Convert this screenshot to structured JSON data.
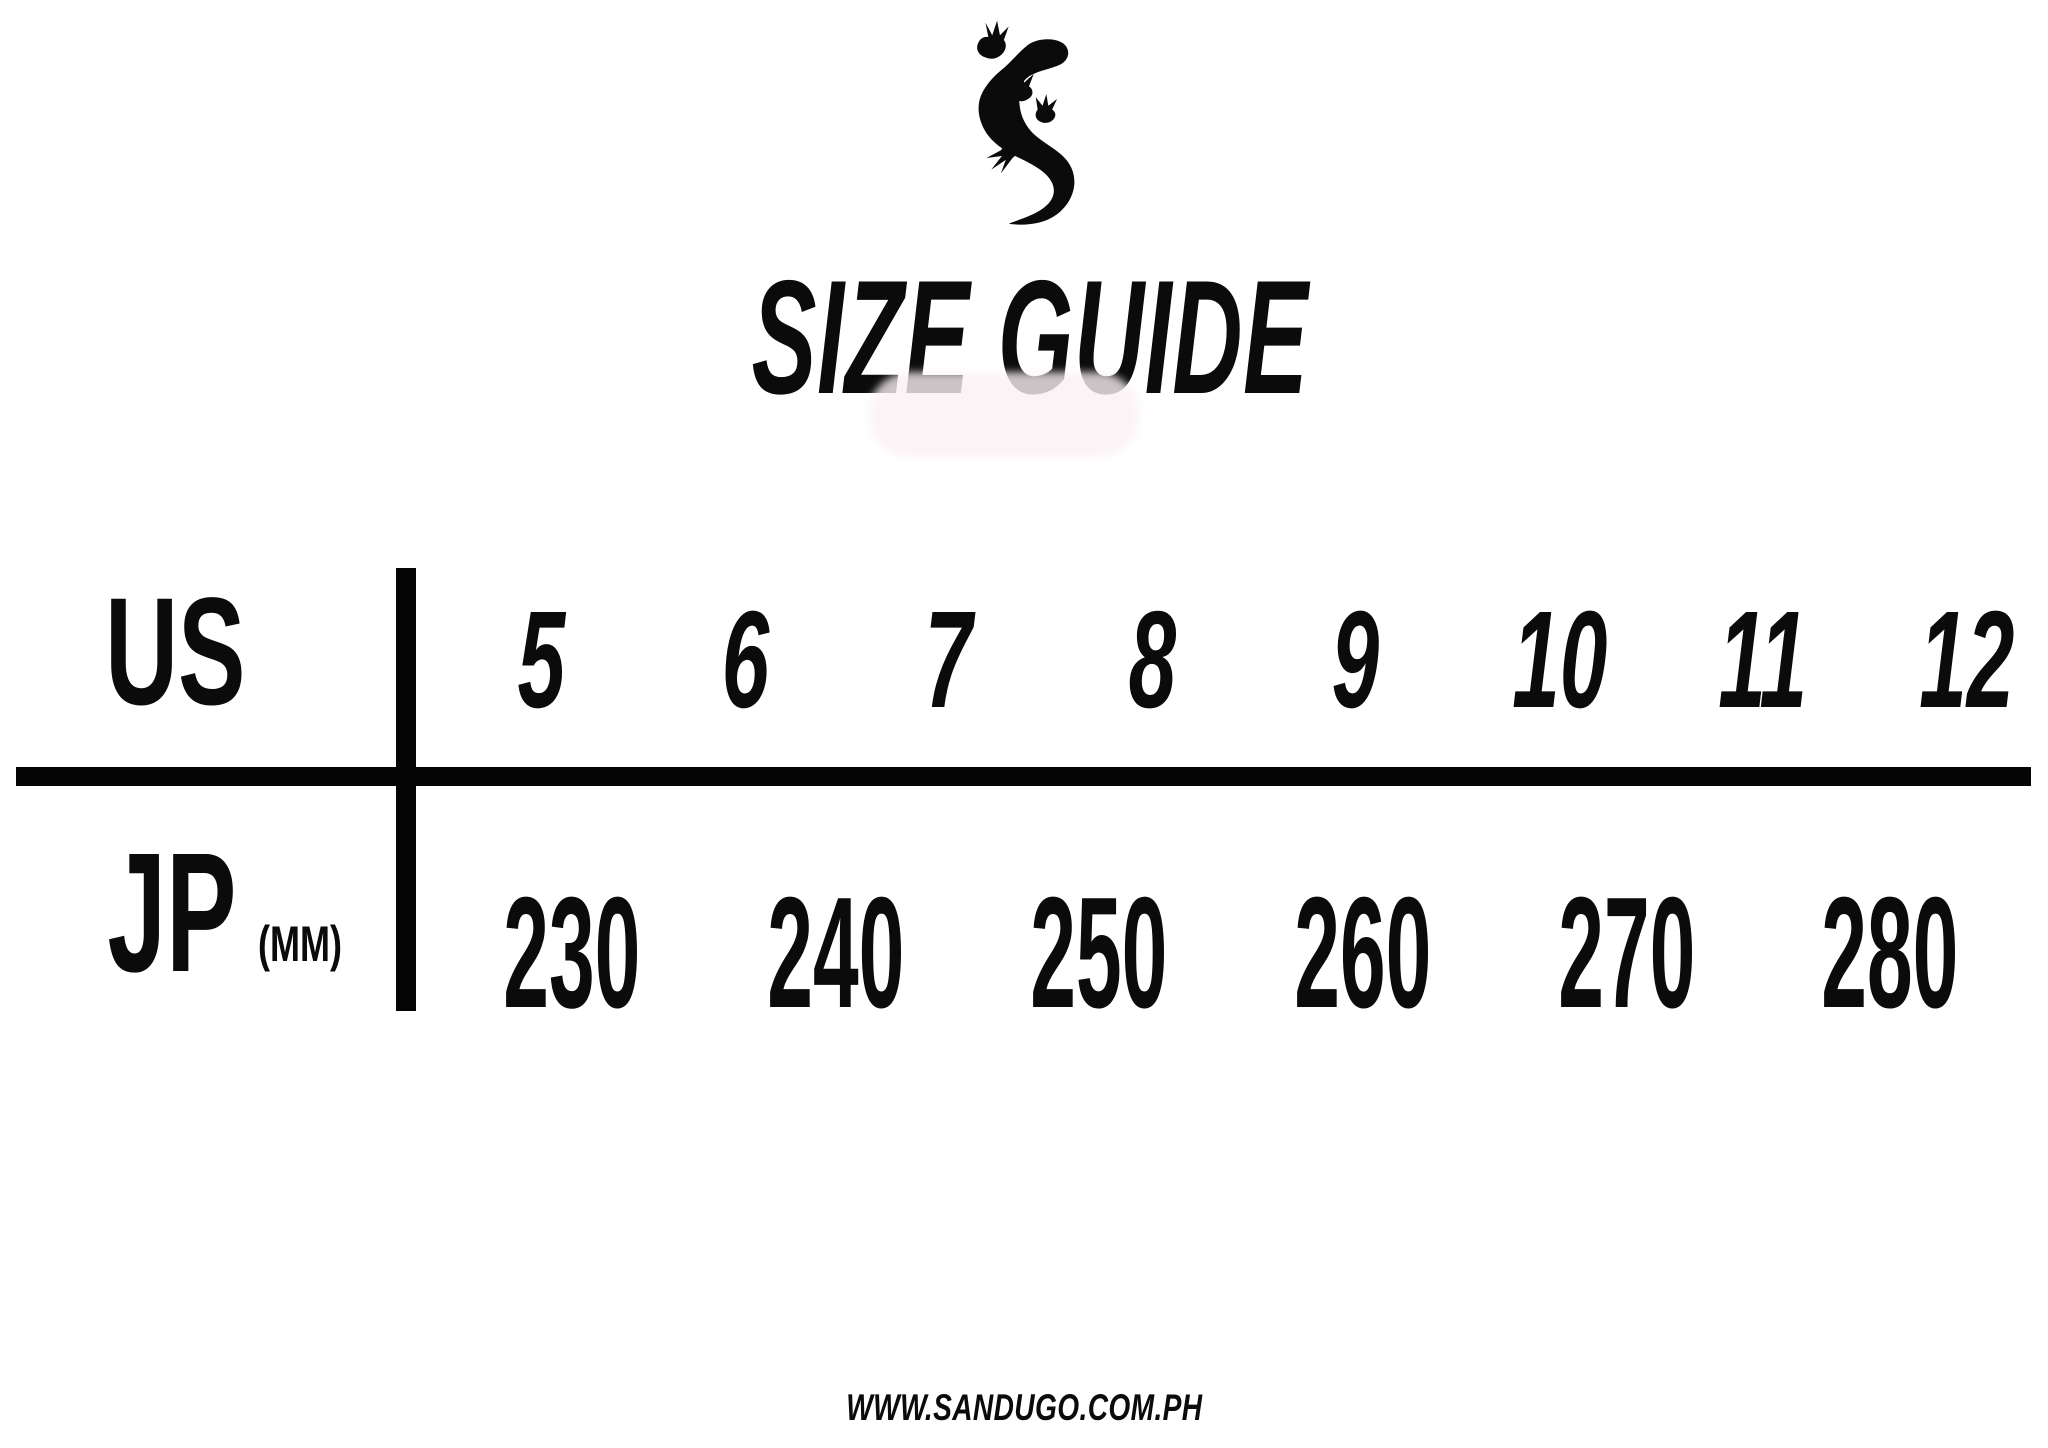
{
  "page": {
    "background": "#ffffff",
    "ink": "#0b0b0b"
  },
  "logo": {
    "icon": "gecko-lizard-logo"
  },
  "chart_data": {
    "type": "table",
    "title": "SIZE GUIDE",
    "rows": [
      {
        "label": "US",
        "unit": "",
        "values": [
          5,
          6,
          7,
          8,
          9,
          10,
          11,
          12
        ]
      },
      {
        "label": "JP",
        "unit": "(MM)",
        "values": [
          230,
          240,
          250,
          260,
          270,
          280,
          290,
          300
        ]
      }
    ],
    "layout": {
      "columns": 8,
      "grid": "thick black cross rules",
      "legend_position": "none"
    },
    "footer": "WWW.SANDUGO.COM.PH"
  }
}
